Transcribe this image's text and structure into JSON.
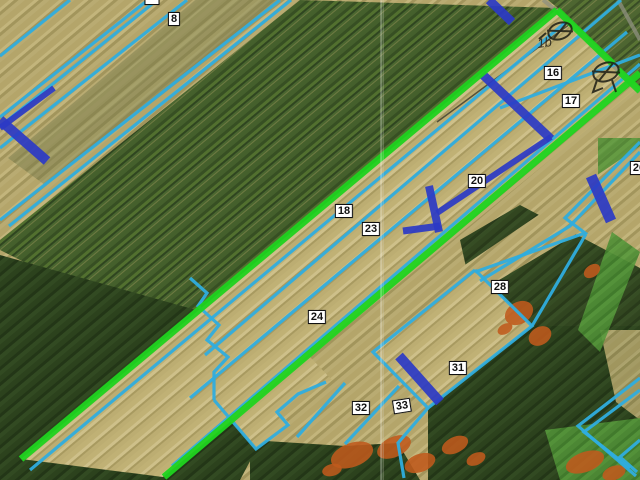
{
  "map": {
    "description": "scanned aerial orthophoto with cadastral parcel overlay",
    "colors": {
      "selection_green": "#1fd41f",
      "parcel_cyan": "#2fadde",
      "drainage_navy": "#2b3ac6",
      "marked_orange": "#bf5a1c",
      "road_grey": "#8f9080",
      "divider_dark": "#3a3a2c",
      "label_bg": "#ffffff",
      "label_border": "#101010",
      "ink_black": "#1d1d14"
    },
    "labels": [
      {
        "text": "8",
        "x": 174,
        "y": 19
      },
      {
        "text": "16",
        "x": 553,
        "y": 73
      },
      {
        "text": "17",
        "x": 571,
        "y": 101
      },
      {
        "text": "18",
        "x": 344,
        "y": 211
      },
      {
        "text": "20",
        "x": 477,
        "y": 181
      },
      {
        "text": "23",
        "x": 371,
        "y": 229
      },
      {
        "text": "24",
        "x": 317,
        "y": 317
      },
      {
        "text": "26",
        "x": 639,
        "y": 168
      },
      {
        "text": "28",
        "x": 500,
        "y": 287
      },
      {
        "text": "31",
        "x": 458,
        "y": 368
      },
      {
        "text": "32",
        "x": 361,
        "y": 408
      },
      {
        "text": "33",
        "x": 402,
        "y": 406,
        "rot": -9
      },
      {
        "text": "",
        "x": 152,
        "y": -2,
        "partial": true
      }
    ],
    "annotations": {
      "handwritten_text": "1b",
      "crossed_circles": [
        {
          "cx": 560,
          "cy": 31,
          "rx": 12,
          "ry": 8,
          "rot": -20
        },
        {
          "cx": 606,
          "cy": 72,
          "rx": 13,
          "ry": 9,
          "rot": -20
        }
      ]
    },
    "overlay": {
      "line_groups": [
        {
          "name": "road-line",
          "color": "#8f9080",
          "width": 4,
          "opacity": 0.75,
          "lines": [
            {
              "pts": [
                [
                  543,
                  0
                ],
                [
                  558,
                  12
                ],
                [
                  640,
                  92
                ]
              ]
            },
            {
              "pts": [
                [
                  618,
                  0
                ],
                [
                  640,
                  40
                ]
              ]
            }
          ]
        },
        {
          "name": "field-divider-line",
          "color": "#3a3a2c",
          "width": 1.5,
          "opacity": 0.8,
          "lines": [
            {
              "pts": [
                [
                  570,
                  24
                ],
                [
                  437,
                  122
                ]
              ]
            }
          ]
        },
        {
          "name": "parcel-boundary-cyan",
          "color": "#2fadde",
          "width": 3.2,
          "opacity": 0.95,
          "lines": [
            {
              "pts": [
                [
                  70,
                  0
                ],
                [
                  0,
                  56
                ]
              ]
            },
            {
              "pts": [
                [
                  148,
                  0
                ],
                [
                  0,
                  117
                ]
              ]
            },
            {
              "pts": [
                [
                  157,
                  0
                ],
                [
                  8,
                  120
                ]
              ]
            },
            {
              "pts": [
                [
                  187,
                  0
                ],
                [
                  0,
                  148
                ]
              ]
            },
            {
              "pts": [
                [
                  280,
                  0
                ],
                [
                  0,
                  220
                ]
              ]
            },
            {
              "pts": [
                [
                  291,
                  0
                ],
                [
                  9,
                  226
                ]
              ]
            },
            {
              "pts": [
                [
                  566,
                  22
                ],
                [
                  30,
                  470
                ]
              ]
            },
            {
              "pts": [
                [
                  621,
                  0
                ],
                [
                  205,
                  355
                ]
              ]
            },
            {
              "pts": [
                [
                  627,
                  32
                ],
                [
                  190,
                  398
                ]
              ]
            },
            {
              "pts": [
                [
                  640,
                  64
                ],
                [
                  172,
                  466
                ]
              ]
            },
            {
              "pts": [
                [
                  640,
                  55
                ],
                [
                  500,
                  108
                ]
              ]
            },
            {
              "pts": [
                [
                  640,
                  142
                ],
                [
                  565,
                  218
                ],
                [
                  585,
                  233
                ],
                [
                  475,
                  272
                ]
              ]
            },
            {
              "pts": [
                [
                  640,
                  152
                ],
                [
                  570,
                  226
                ],
                [
                  480,
                  281
                ]
              ]
            },
            {
              "pts": [
                [
                  586,
                  234
                ],
                [
                  532,
                  326
                ]
              ]
            },
            {
              "pts": [
                [
                  475,
                  270
                ],
                [
                  373,
                  352
                ],
                [
                  428,
                  408
                ],
                [
                  532,
                  326
                ],
                [
                  475,
                  270
                ]
              ]
            },
            {
              "pts": [
                [
                  190,
                  278
                ],
                [
                  207,
                  293
                ],
                [
                  198,
                  306
                ],
                [
                  219,
                  325
                ],
                [
                  207,
                  340
                ],
                [
                  228,
                  357
                ],
                [
                  214,
                  372
                ],
                [
                  214,
                  400
                ]
              ]
            },
            {
              "pts": [
                [
                  214,
                  400
                ],
                [
                  256,
                  449
                ],
                [
                  288,
                  425
                ],
                [
                  277,
                  412
                ],
                [
                  298,
                  394
                ],
                [
                  326,
                  382
                ]
              ]
            },
            {
              "pts": [
                [
                  399,
                  386
                ],
                [
                  345,
                  444
                ]
              ]
            },
            {
              "pts": [
                [
                  345,
                  383
                ],
                [
                  297,
                  437
                ]
              ]
            },
            {
              "pts": [
                [
                  428,
                  408
                ],
                [
                  398,
                  443
                ],
                [
                  404,
                  478
                ]
              ]
            },
            {
              "pts": [
                [
                  640,
                  378
                ],
                [
                  578,
                  426
                ],
                [
                  636,
                  476
                ]
              ]
            },
            {
              "pts": [
                [
                  640,
                  390
                ],
                [
                  584,
                  432
                ],
                [
                  630,
                  468
                ]
              ]
            },
            {
              "pts": [
                [
                  640,
                  440
                ],
                [
                  620,
                  457
                ],
                [
                  637,
                  472
                ]
              ]
            }
          ]
        },
        {
          "name": "drainage-line-navy",
          "color": "#2b3ac6",
          "width": 8,
          "opacity": 0.92,
          "lines": [
            {
              "pts": [
                [
                  482,
                  74
                ],
                [
                  551,
                  139
                ]
              ],
              "w": 9
            },
            {
              "pts": [
                [
                  551,
                  137
                ],
                [
                  437,
                  213
                ]
              ],
              "w": 6
            },
            {
              "pts": [
                [
                  591,
                  176
                ],
                [
                  611,
                  221
                ]
              ],
              "w": 11
            },
            {
              "pts": [
                [
                  429,
                  186
                ],
                [
                  439,
                  232
                ]
              ],
              "w": 8
            },
            {
              "pts": [
                [
                  403,
                  231
                ],
                [
                  440,
                  226
                ]
              ],
              "w": 7
            },
            {
              "pts": [
                [
                  0,
                  120
                ],
                [
                  47,
                  161
                ]
              ],
              "w": 10
            },
            {
              "pts": [
                [
                  0,
                  128
                ],
                [
                  54,
                  88
                ]
              ],
              "w": 6
            },
            {
              "pts": [
                [
                  399,
                  356
                ],
                [
                  440,
                  402
                ]
              ],
              "w": 10
            },
            {
              "pts": [
                [
                  489,
                  0
                ],
                [
                  512,
                  22
                ]
              ],
              "w": 9
            }
          ]
        },
        {
          "name": "selection-boundary-green",
          "color": "#1fd41f",
          "width": 7,
          "opacity": 0.95,
          "lines": [
            {
              "pts": [
                [
                  557,
                  10
                ],
                [
                  21,
                  459
                ]
              ]
            },
            {
              "pts": [
                [
                  557,
                  10
                ],
                [
                  613,
                  64
                ]
              ]
            },
            {
              "pts": [
                [
                  618,
                  70
                ],
                [
                  640,
                  91
                ]
              ]
            },
            {
              "pts": [
                [
                  640,
                  73
                ],
                [
                  164,
                  477
                ]
              ]
            }
          ]
        }
      ],
      "orange_areas": [
        {
          "cx": 519,
          "cy": 313,
          "rx": 15,
          "ry": 11,
          "rot": -30
        },
        {
          "cx": 540,
          "cy": 336,
          "rx": 12,
          "ry": 9,
          "rot": -30
        },
        {
          "cx": 505,
          "cy": 329,
          "rx": 8,
          "ry": 5,
          "rot": -30
        },
        {
          "cx": 592,
          "cy": 271,
          "rx": 9,
          "ry": 6,
          "rot": -35
        },
        {
          "cx": 352,
          "cy": 455,
          "rx": 22,
          "ry": 12,
          "rot": -20
        },
        {
          "cx": 394,
          "cy": 447,
          "rx": 18,
          "ry": 10,
          "rot": -25
        },
        {
          "cx": 420,
          "cy": 463,
          "rx": 16,
          "ry": 9,
          "rot": -20
        },
        {
          "cx": 332,
          "cy": 470,
          "rx": 10,
          "ry": 6,
          "rot": -15
        },
        {
          "cx": 455,
          "cy": 445,
          "rx": 14,
          "ry": 8,
          "rot": -25
        },
        {
          "cx": 476,
          "cy": 459,
          "rx": 10,
          "ry": 6,
          "rot": -25
        },
        {
          "cx": 585,
          "cy": 462,
          "rx": 20,
          "ry": 10,
          "rot": -20
        },
        {
          "cx": 614,
          "cy": 473,
          "rx": 12,
          "ry": 7,
          "rot": -20
        }
      ]
    }
  }
}
